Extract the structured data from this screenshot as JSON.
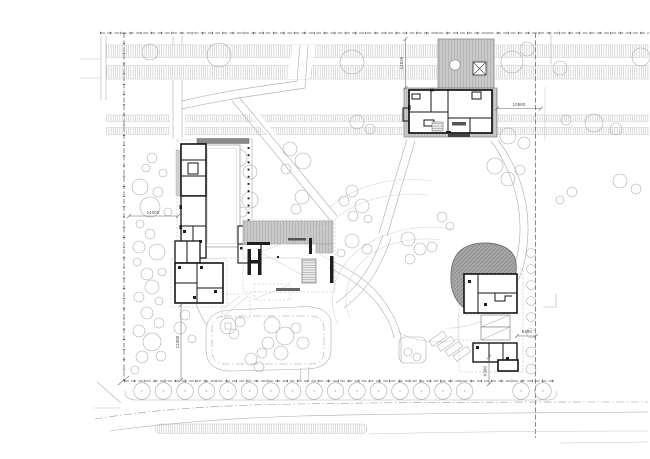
{
  "dimensions": {
    "d14000": "14000",
    "d21000": "21000",
    "d12836": "12836",
    "d10980": "10980",
    "d5280": "5280",
    "d6300": "6300"
  },
  "palette": {
    "background": "#ffffff",
    "line_light": "#c4c4c4",
    "line_path": "#b3b3b3",
    "boundary": "#4a4a4a",
    "wall_black": "#141414",
    "roof_stripe_gray": "#c9c9c9",
    "canopy_blob_gray": "#a8a8a8",
    "dimension_text": "#4f4f4f"
  }
}
